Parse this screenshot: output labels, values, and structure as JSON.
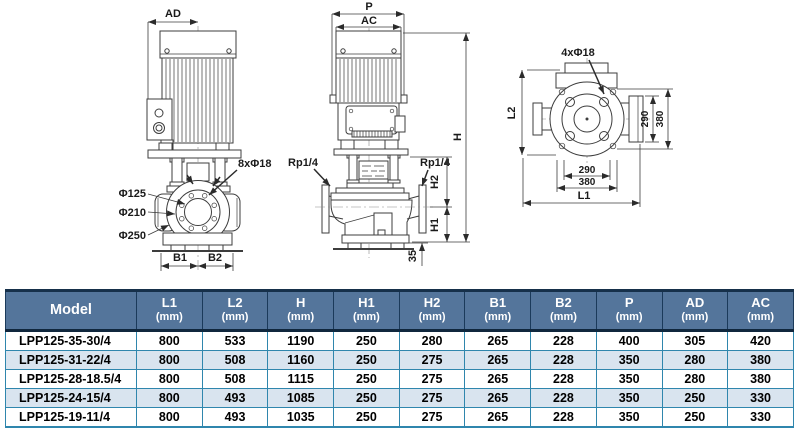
{
  "drawings": {
    "side_view": {
      "dim_ad": "AD",
      "bolt_label": "8xΦ18",
      "phi_125": "Φ125",
      "phi_210": "Φ210",
      "phi_250": "Φ250",
      "dim_b1": "B1",
      "dim_b2": "B2"
    },
    "front_view": {
      "dim_p": "P",
      "dim_ac": "AC",
      "dim_h": "H",
      "dim_h2": "H2",
      "dim_h1": "H1",
      "dim_35": "35",
      "rp_left": "Rp1/4",
      "rp_right": "Rp1/4"
    },
    "top_view": {
      "bolt_label": "4xΦ18",
      "dim_l2": "L2",
      "dim_l1": "L1",
      "dim_290_right": "290",
      "dim_380_right": "380",
      "dim_290_bottom": "290",
      "dim_380_bottom": "380"
    }
  },
  "table": {
    "colors": {
      "header_bg": "#54759b",
      "header_text": "#ffffff",
      "row_alt_bg": "#d9e4ef",
      "grid": "#2f86ad",
      "header_border": "#10273d"
    },
    "header": {
      "model": "Model",
      "unit": "(mm)",
      "columns": [
        "L1",
        "L2",
        "H",
        "H1",
        "H2",
        "B1",
        "B2",
        "P",
        "AD",
        "AC"
      ]
    },
    "rows": [
      {
        "model": "LPP125-35-30/4",
        "values": [
          "800",
          "533",
          "1190",
          "250",
          "280",
          "265",
          "228",
          "400",
          "305",
          "420"
        ]
      },
      {
        "model": "LPP125-31-22/4",
        "values": [
          "800",
          "508",
          "1160",
          "250",
          "275",
          "265",
          "228",
          "350",
          "280",
          "380"
        ]
      },
      {
        "model": "LPP125-28-18.5/4",
        "values": [
          "800",
          "508",
          "1115",
          "250",
          "275",
          "265",
          "228",
          "350",
          "280",
          "380"
        ]
      },
      {
        "model": "LPP125-24-15/4",
        "values": [
          "800",
          "493",
          "1085",
          "250",
          "275",
          "265",
          "228",
          "350",
          "250",
          "330"
        ]
      },
      {
        "model": "LPP125-19-11/4",
        "values": [
          "800",
          "493",
          "1035",
          "250",
          "275",
          "265",
          "228",
          "350",
          "250",
          "330"
        ]
      }
    ]
  }
}
